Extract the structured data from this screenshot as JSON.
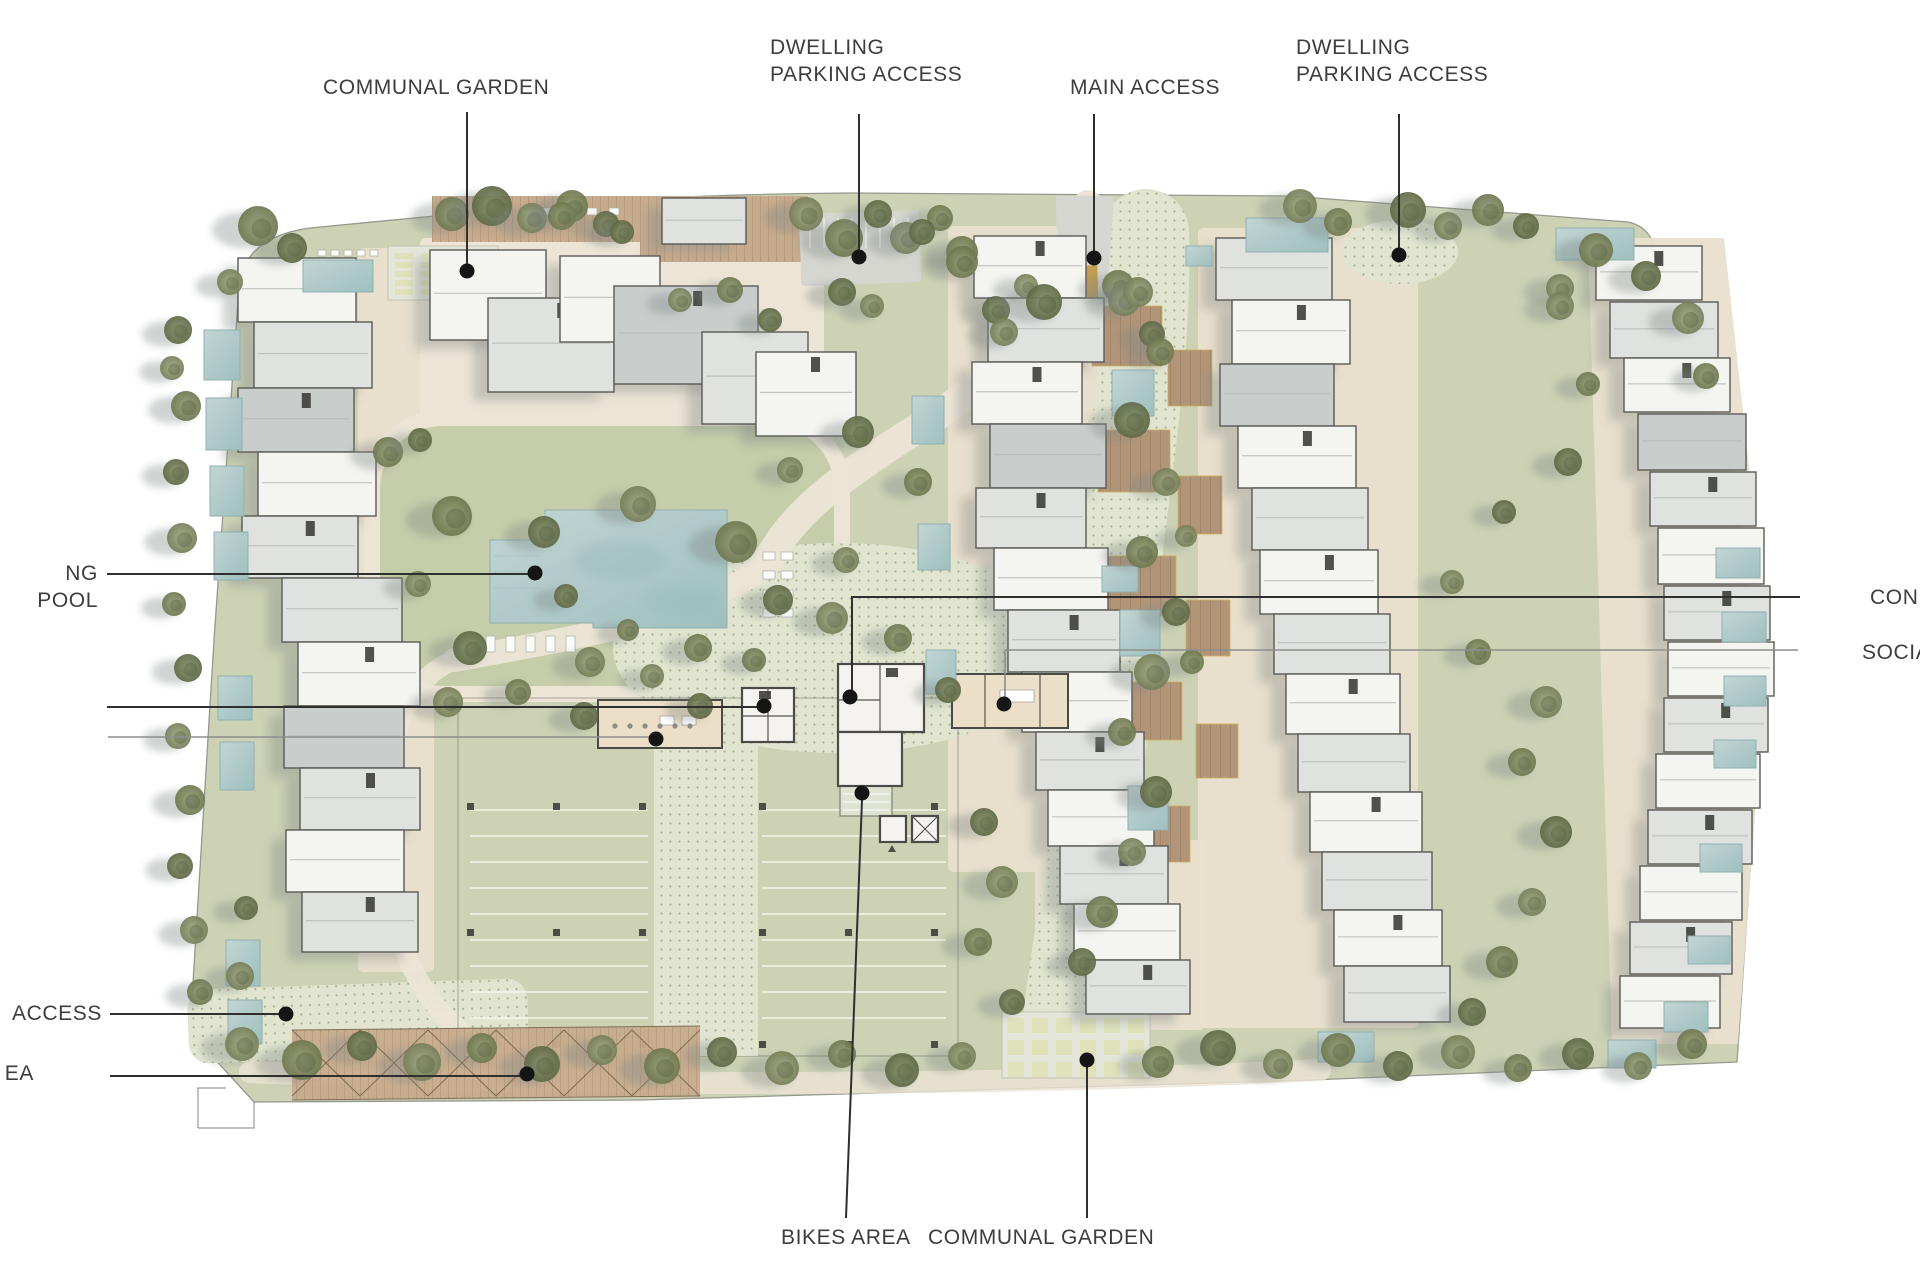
{
  "labels": {
    "communal_garden_top": "COMMUNAL GARDEN",
    "dwelling_parking_left": "DWELLING\nPARKING ACCESS",
    "main_access": "MAIN ACCESS",
    "dwelling_parking_right": "DWELLING\nPARKING ACCESS",
    "swimming_pool_truncated": "NG POOL",
    "concierge_truncated": "CON",
    "social_truncated": "SOCIA",
    "access_truncated": "ACCESS",
    "area_truncated": "EA",
    "bikes_area": "BIKES AREA",
    "communal_garden_bottom": "COMMUNAL GARDEN"
  },
  "colors": {
    "label_text": "#3d3d3d",
    "leader_dark": "#2f2f2f",
    "leader_light": "#8d8d8d",
    "site_green": "#cdd2b5",
    "lawn_green": "#c6cdaa",
    "path_cream": "#ece5d6",
    "terrace_beige": "#e9dfcd",
    "textured_path": "#e1e5d0",
    "pool_blue": "#b5cecd",
    "roof_white": "#f4f4f1",
    "roof_light": "#dfe2df",
    "roof_dark": "#c9cecd",
    "roof_outline": "#5a5a55",
    "wood_deck": "#c8ac90",
    "terrace_brown": "#ab9077",
    "access_ochre": "#c59d4e",
    "shadow_gray": "#878d8a"
  }
}
